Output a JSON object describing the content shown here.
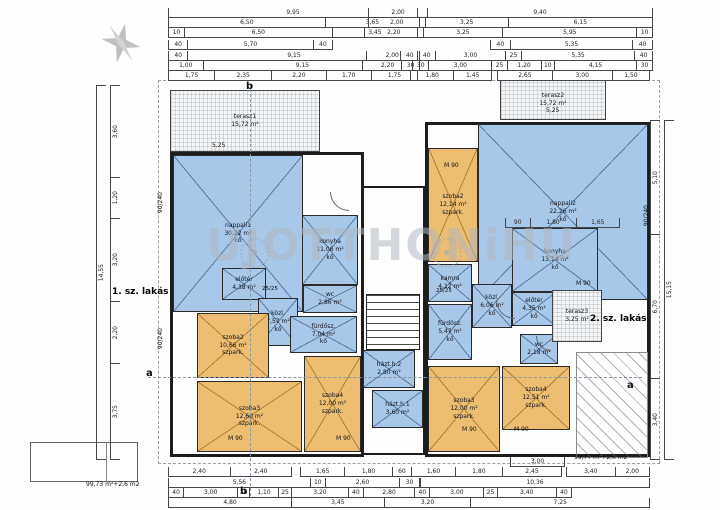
{
  "units": {
    "unit1": "1. sz. lakás",
    "unit2": "2. sz. lakás"
  },
  "watermark": {
    "text": "UJOTTHONiHU"
  },
  "colors": {
    "room_blue": "#a7c8e8",
    "room_orange": "#edbd72",
    "wall": "#1d1d1d",
    "dim_text": "#222222",
    "watermark_gray": "#b0b7c0"
  },
  "rooms": [
    {
      "id": "terasz1",
      "name": "terasz1",
      "area": "15,72 m²",
      "floor": "",
      "fill": "hatch",
      "x": 170,
      "y": 90,
      "w": 150,
      "h": 62
    },
    {
      "id": "terasz2",
      "name": "terasz2",
      "area": "15,72 m²",
      "floor": "",
      "fill": "hatch",
      "x": 500,
      "y": 80,
      "w": 106,
      "h": 40
    },
    {
      "id": "nappali1",
      "name": "nappali1",
      "area": "30,22 m²",
      "floor": "kő",
      "fill": "blue",
      "x": 173,
      "y": 155,
      "w": 130,
      "h": 157
    },
    {
      "id": "konyha1",
      "name": "konyha",
      "area": "11,06 m²",
      "floor": "kő",
      "fill": "blue",
      "x": 302,
      "y": 215,
      "w": 56,
      "h": 70
    },
    {
      "id": "wc1",
      "name": "wc",
      "area": "2,86 m²",
      "floor": "",
      "fill": "blue",
      "x": 303,
      "y": 285,
      "w": 54,
      "h": 28
    },
    {
      "id": "eloter1",
      "name": "előtér",
      "area": "4,38 m²",
      "floor": "",
      "fill": "blue",
      "x": 222,
      "y": 268,
      "w": 44,
      "h": 32
    },
    {
      "id": "kozl1",
      "name": "közl.",
      "area": "7,57 m²",
      "floor": "kő",
      "fill": "blue",
      "x": 258,
      "y": 298,
      "w": 40,
      "h": 48
    },
    {
      "id": "furdosz1",
      "name": "fürdősz.",
      "area": "7,04 m²",
      "floor": "kő",
      "fill": "blue",
      "x": 290,
      "y": 316,
      "w": 67,
      "h": 37
    },
    {
      "id": "szoba2-l",
      "name": "szoba2",
      "area": "10,66 m²",
      "floor": "szpark.",
      "fill": "orange",
      "x": 197,
      "y": 313,
      "w": 72,
      "h": 65
    },
    {
      "id": "szoba3-l",
      "name": "szoba3",
      "area": "12,60 m²",
      "floor": "szpark.",
      "fill": "orange",
      "x": 197,
      "y": 381,
      "w": 105,
      "h": 71
    },
    {
      "id": "szoba4-l",
      "name": "szoba4",
      "area": "12,00 m²",
      "floor": "szpark.",
      "fill": "orange",
      "x": 304,
      "y": 356,
      "w": 57,
      "h": 96
    },
    {
      "id": "hazth2",
      "name": "házt.h.2",
      "area": "2,80 m²",
      "floor": "",
      "fill": "blue",
      "x": 363,
      "y": 350,
      "w": 52,
      "h": 38
    },
    {
      "id": "hazth1",
      "name": "házt.h.1",
      "area": "3,60 m²",
      "floor": "",
      "fill": "blue",
      "x": 372,
      "y": 390,
      "w": 51,
      "h": 38
    },
    {
      "id": "nappali2",
      "name": "nappali2",
      "area": "22,26 m²",
      "floor": "kő",
      "fill": "blue",
      "x": 478,
      "y": 124,
      "w": 170,
      "h": 176
    },
    {
      "id": "szoba2-r",
      "name": "szoba2",
      "area": "12,14 m²",
      "floor": "szpark.",
      "fill": "orange",
      "x": 428,
      "y": 148,
      "w": 50,
      "h": 114
    },
    {
      "id": "konyha2",
      "name": "konyha",
      "area": "13,14 m²",
      "floor": "kő",
      "fill": "blue",
      "x": 512,
      "y": 228,
      "w": 86,
      "h": 64
    },
    {
      "id": "kamra",
      "name": "kamra",
      "area": "4,12 m²",
      "floor": "",
      "fill": "blue",
      "x": 428,
      "y": 264,
      "w": 44,
      "h": 38
    },
    {
      "id": "kozl2",
      "name": "közl.",
      "area": "6,06 m²",
      "floor": "kő",
      "fill": "blue",
      "x": 472,
      "y": 284,
      "w": 40,
      "h": 44
    },
    {
      "id": "furdosz2",
      "name": "fürdősz.",
      "area": "5,47 m²",
      "floor": "kő",
      "fill": "blue",
      "x": 428,
      "y": 304,
      "w": 44,
      "h": 56
    },
    {
      "id": "eloter2",
      "name": "előtér",
      "area": "4,35 m²",
      "floor": "kő",
      "fill": "blue",
      "x": 512,
      "y": 292,
      "w": 44,
      "h": 34
    },
    {
      "id": "wc2",
      "name": "wc",
      "area": "2,18 m²",
      "floor": "",
      "fill": "blue",
      "x": 520,
      "y": 334,
      "w": 38,
      "h": 30
    },
    {
      "id": "szoba3-r",
      "name": "szoba3",
      "area": "12,00 m²",
      "floor": "szpark.",
      "fill": "orange",
      "x": 428,
      "y": 366,
      "w": 72,
      "h": 86
    },
    {
      "id": "szoba4-r",
      "name": "szoba4",
      "area": "12,51 m²",
      "floor": "szpark.",
      "fill": "orange",
      "x": 502,
      "y": 366,
      "w": 68,
      "h": 64
    },
    {
      "id": "terasz3",
      "name": "terasz3",
      "area": "3,25 m²",
      "floor": "",
      "fill": "hatch",
      "x": 552,
      "y": 290,
      "w": 50,
      "h": 52
    }
  ],
  "dim_rows": [
    {
      "x": 168,
      "y": 8,
      "w": 250,
      "segs": [
        [
          "9,95",
          9.95
        ]
      ]
    },
    {
      "x": 168,
      "y": 18,
      "w": 252,
      "segs": [
        [
          "6,50",
          6.5
        ],
        [
          "3,65",
          3.65
        ]
      ]
    },
    {
      "x": 168,
      "y": 28,
      "w": 250,
      "segs": [
        [
          "10",
          0.35
        ],
        [
          "6,50",
          6.5
        ],
        [
          "3,45",
          3.45
        ]
      ]
    },
    {
      "x": 168,
      "y": 40,
      "w": 165,
      "segs": [
        [
          "40",
          0.55
        ],
        [
          "5,70",
          5.7
        ],
        [
          "40",
          0.55
        ]
      ]
    },
    {
      "x": 168,
      "y": 51,
      "w": 252,
      "segs": [
        [
          "40",
          0.5
        ],
        [
          "9,15",
          9.15
        ],
        [
          "40",
          0.5
        ]
      ]
    },
    {
      "x": 168,
      "y": 61,
      "w": 252,
      "segs": [
        [
          "1,00",
          1.0
        ],
        [
          "9,15",
          9.15
        ],
        [
          "30",
          0.45
        ]
      ]
    },
    {
      "x": 168,
      "y": 71,
      "w": 250,
      "segs": [
        [
          "1,75",
          1.75
        ],
        [
          "2,35",
          2.35
        ],
        [
          "2,20",
          2.2
        ],
        [
          "1,70",
          1.7
        ],
        [
          "1,75",
          1.75
        ]
      ]
    },
    {
      "x": 368,
      "y": 8,
      "w": 285,
      "segs": [
        [
          "2,00",
          2.0
        ],
        [
          "9,40",
          9.4
        ]
      ]
    },
    {
      "x": 368,
      "y": 18,
      "w": 285,
      "segs": [
        [
          "2,00",
          2.0
        ],
        [
          "3,25",
          3.25
        ],
        [
          "6,15",
          6.15
        ]
      ]
    },
    {
      "x": 364,
      "y": 28,
      "w": 289,
      "segs": [
        [
          "2,20",
          2.2
        ],
        [
          "3,25",
          3.25
        ],
        [
          "5,95",
          5.95
        ],
        [
          "10",
          0.35
        ]
      ]
    },
    {
      "x": 490,
      "y": 40,
      "w": 163,
      "segs": [
        [
          "40",
          0.55
        ],
        [
          "5,35",
          5.35
        ],
        [
          "40",
          0.55
        ]
      ]
    },
    {
      "x": 366,
      "y": 51,
      "w": 287,
      "segs": [
        [
          "2,00",
          2.0
        ],
        [
          "40",
          0.5
        ],
        [
          "3,00",
          3.0
        ],
        [
          "25",
          0.4
        ],
        [
          "5,35",
          5.35
        ],
        [
          "40",
          0.5
        ]
      ]
    },
    {
      "x": 362,
      "y": 61,
      "w": 291,
      "segs": [
        [
          "2,20",
          2.2
        ],
        [
          "30",
          0.45
        ],
        [
          "3,00",
          3.0
        ],
        [
          "25",
          0.4
        ],
        [
          "1,20",
          1.2
        ],
        [
          "10",
          0.3
        ],
        [
          "4,15",
          4.15
        ],
        [
          "30",
          0.45
        ]
      ]
    },
    {
      "x": 410,
      "y": 71,
      "w": 82,
      "segs": [
        [
          "1,80",
          1.8
        ],
        [
          "1,45",
          1.45
        ]
      ]
    },
    {
      "x": 497,
      "y": 71,
      "w": 153,
      "segs": [
        [
          "2,65",
          2.65
        ],
        [
          "3,00",
          3.0
        ],
        [
          "1,50",
          1.5
        ]
      ]
    },
    {
      "x": 505,
      "y": 218,
      "w": 115,
      "segs": [
        [
          "90",
          0.9
        ],
        [
          "1,80",
          1.8
        ],
        [
          "1,65",
          1.65
        ]
      ]
    },
    {
      "x": 510,
      "y": 457,
      "w": 55,
      "segs": [
        [
          "3,00",
          3.0
        ]
      ]
    },
    {
      "x": 168,
      "y": 467,
      "w": 124,
      "segs": [
        [
          "2,40",
          2.4
        ],
        [
          "2,40",
          2.4
        ]
      ]
    },
    {
      "x": 300,
      "y": 467,
      "w": 262,
      "segs": [
        [
          "1,65",
          1.65
        ],
        [
          "1,80",
          1.8
        ],
        [
          "60",
          0.6
        ],
        [
          "1,60",
          1.6
        ],
        [
          "1,80",
          1.8
        ],
        [
          "2,45",
          2.45
        ]
      ]
    },
    {
      "x": 566,
      "y": 467,
      "w": 84,
      "segs": [
        [
          "3,40",
          3.4
        ],
        [
          "2,00",
          2.0
        ]
      ]
    },
    {
      "x": 168,
      "y": 478,
      "w": 252,
      "segs": [
        [
          "5,56",
          5.56
        ],
        [
          "10",
          0.3
        ],
        [
          "2,60",
          2.6
        ],
        [
          "30",
          0.5
        ]
      ]
    },
    {
      "x": 420,
      "y": 478,
      "w": 230,
      "segs": [
        [
          "10,36",
          10.36
        ]
      ]
    },
    {
      "x": 168,
      "y": 488,
      "w": 404,
      "segs": [
        [
          "40",
          0.5
        ],
        [
          "3,00",
          3.0
        ],
        [
          "10",
          0.25
        ],
        [
          "1,10",
          1.1
        ],
        [
          "25",
          0.35
        ],
        [
          "3,20",
          3.2
        ],
        [
          "40",
          0.5
        ],
        [
          "2,80",
          2.8
        ],
        [
          "40",
          0.5
        ],
        [
          "3,00",
          3.0
        ],
        [
          "25",
          0.35
        ],
        [
          "3,40",
          3.4
        ],
        [
          "40",
          0.5
        ]
      ]
    },
    {
      "x": 168,
      "y": 498,
      "w": 482,
      "segs": [
        [
          "4,80",
          4.8
        ],
        [
          "3,45",
          3.45
        ],
        [
          "3,20",
          3.2
        ],
        [
          "7,25",
          7.25
        ]
      ]
    }
  ],
  "vdim_rows": [
    {
      "x": 96,
      "y": 85,
      "h": 375,
      "segs": [
        [
          "14,55",
          14.55
        ]
      ]
    },
    {
      "x": 110,
      "y": 85,
      "h": 375,
      "segs": [
        [
          "3,60",
          3.6
        ],
        [
          "1,20",
          1.2
        ],
        [
          "3,20",
          3.2
        ],
        [
          "2,20",
          2.2
        ],
        [
          "3,75",
          3.75
        ]
      ]
    },
    {
      "x": 650,
      "y": 120,
      "h": 340,
      "segs": [
        [
          "5,10",
          5.1
        ],
        [
          "6,70",
          6.7
        ],
        [
          "3,40",
          3.4
        ]
      ]
    },
    {
      "x": 664,
      "y": 120,
      "h": 340,
      "segs": [
        [
          "15,15",
          15.15
        ]
      ]
    }
  ],
  "labels": [
    {
      "t": "b",
      "x": 246,
      "y": 82,
      "s": 10,
      "b": true,
      "n": "section-marker-b-top"
    },
    {
      "t": "b",
      "x": 240,
      "y": 487,
      "s": 10,
      "b": true,
      "n": "section-marker-b-bottom"
    },
    {
      "t": "a",
      "x": 146,
      "y": 369,
      "s": 10,
      "b": true,
      "n": "section-marker-a-left"
    },
    {
      "t": "a",
      "x": 627,
      "y": 381,
      "s": 10,
      "b": true,
      "n": "section-marker-a-right"
    },
    {
      "t": "M 90",
      "x": 444,
      "y": 163,
      "s": 6,
      "n": "door-size-label"
    },
    {
      "t": "M 90",
      "x": 576,
      "y": 281,
      "s": 6,
      "n": "door-size-label"
    },
    {
      "t": "M 90",
      "x": 462,
      "y": 427,
      "s": 6,
      "n": "door-size-label"
    },
    {
      "t": "M 90",
      "x": 514,
      "y": 427,
      "s": 6,
      "n": "door-size-label"
    },
    {
      "t": "M 90",
      "x": 336,
      "y": 436,
      "s": 6,
      "n": "door-size-label"
    },
    {
      "t": "M 90",
      "x": 228,
      "y": 436,
      "s": 6,
      "n": "door-size-label"
    },
    {
      "t": "90/240",
      "x": 158,
      "y": 192,
      "s": 6,
      "rot": true,
      "n": "window-size-label"
    },
    {
      "t": "90/240",
      "x": 158,
      "y": 328,
      "s": 6,
      "rot": true,
      "n": "window-size-label"
    },
    {
      "t": "90/240",
      "x": 644,
      "y": 205,
      "s": 6,
      "rot": true,
      "n": "window-size-label"
    },
    {
      "t": "5,25",
      "x": 212,
      "y": 143,
      "s": 6,
      "n": "terrace-width-label"
    },
    {
      "t": "5,25",
      "x": 546,
      "y": 108,
      "s": 6,
      "n": "terrace-width-label"
    },
    {
      "t": "25/25",
      "x": 262,
      "y": 287,
      "s": 5.5,
      "n": "pillar-size-label"
    },
    {
      "t": "25/25",
      "x": 436,
      "y": 289,
      "s": 5.5,
      "n": "pillar-size-label"
    },
    {
      "t": "99,73 m²+2,6 m2",
      "x": 86,
      "y": 482,
      "s": 6,
      "n": "area-total-label-left"
    },
    {
      "t": "99,77 m²+2,6 m2",
      "x": 574,
      "y": 455,
      "s": 6,
      "n": "area-total-label-right"
    }
  ]
}
